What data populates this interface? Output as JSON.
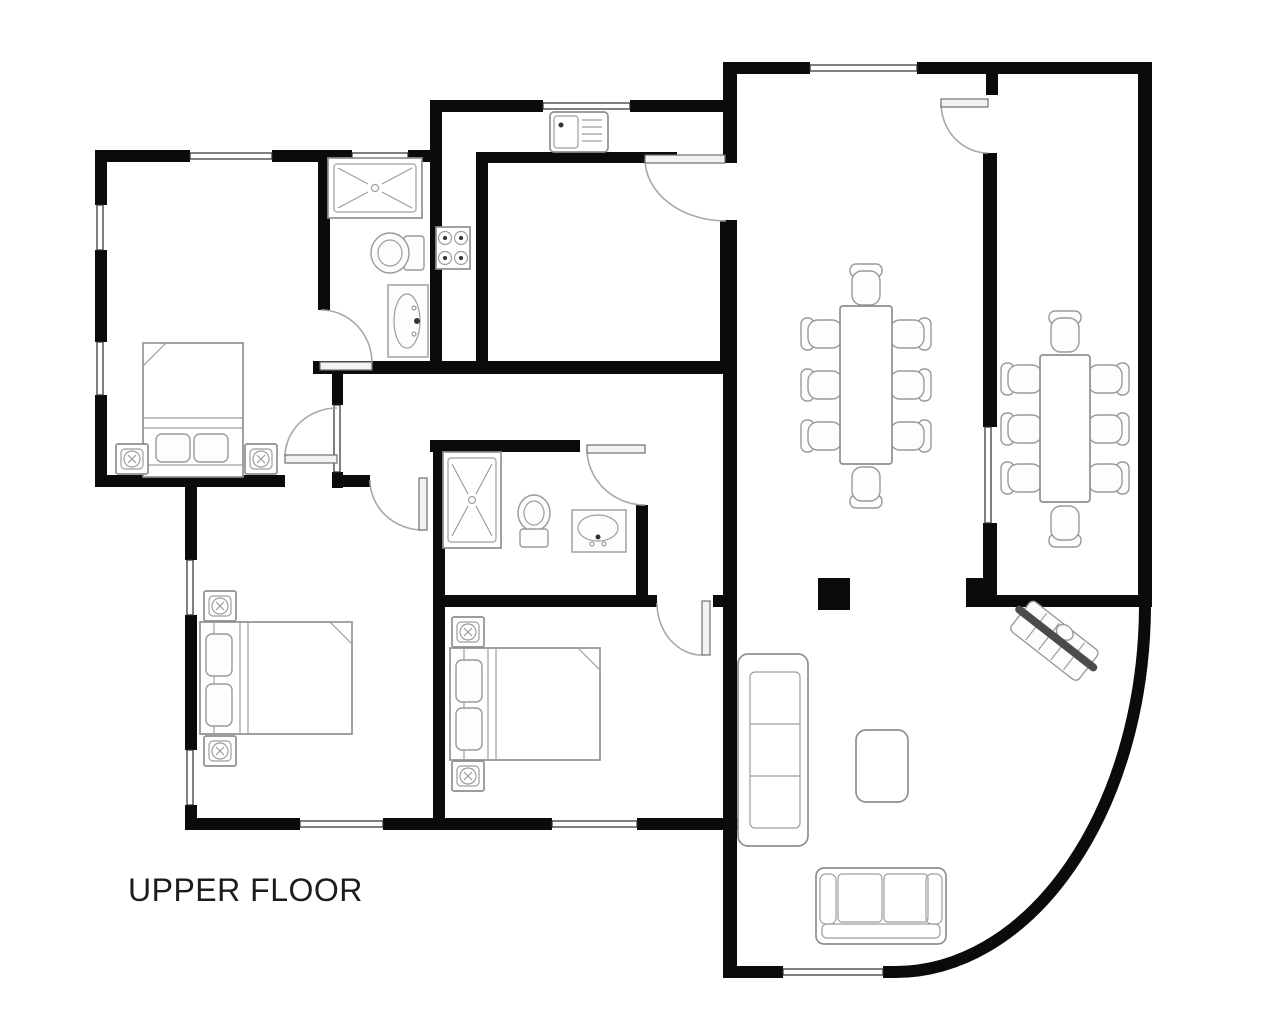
{
  "title": "UPPER FLOOR",
  "colors": {
    "wall": "#0b0b0b",
    "furniture_outline": "#8f8f8f",
    "door_arc": "#a8a8a8",
    "stair_rail": "#4b4b4b",
    "background": "#ffffff",
    "label_text": "#1c1c1c"
  },
  "plan": {
    "type": "architectural-floor-plan",
    "floor_label": "UPPER FLOOR",
    "rooms": [
      "bedroom-top-left",
      "bathroom-top",
      "kitchen-l-strip",
      "inner-dining-room",
      "table-room-left",
      "table-room-right",
      "hallway-middle",
      "bathroom-middle",
      "bedroom-bottom-left",
      "bedroom-bottom-middle",
      "living-area-curved"
    ],
    "furniture_symbols": [
      "double-bed (x3) with pillows and fold-back corner",
      "nightstand (x6)",
      "shower-tray (x2)",
      "toilet (x2)",
      "washbasin (x2)",
      "kitchen-sink with drainer",
      "stove 4-burner",
      "table with 8 chairs (x2)",
      "sofa 3-seat vertical",
      "sofa 2-seat horizontal",
      "coffee-table",
      "staircase diagonal with rail",
      "structural-column"
    ],
    "openings": [
      "windows shown as thin double lines in wall gaps",
      "doors shown as quarter-circle swing arcs with leaf",
      "curved exterior wall at bottom right"
    ]
  }
}
